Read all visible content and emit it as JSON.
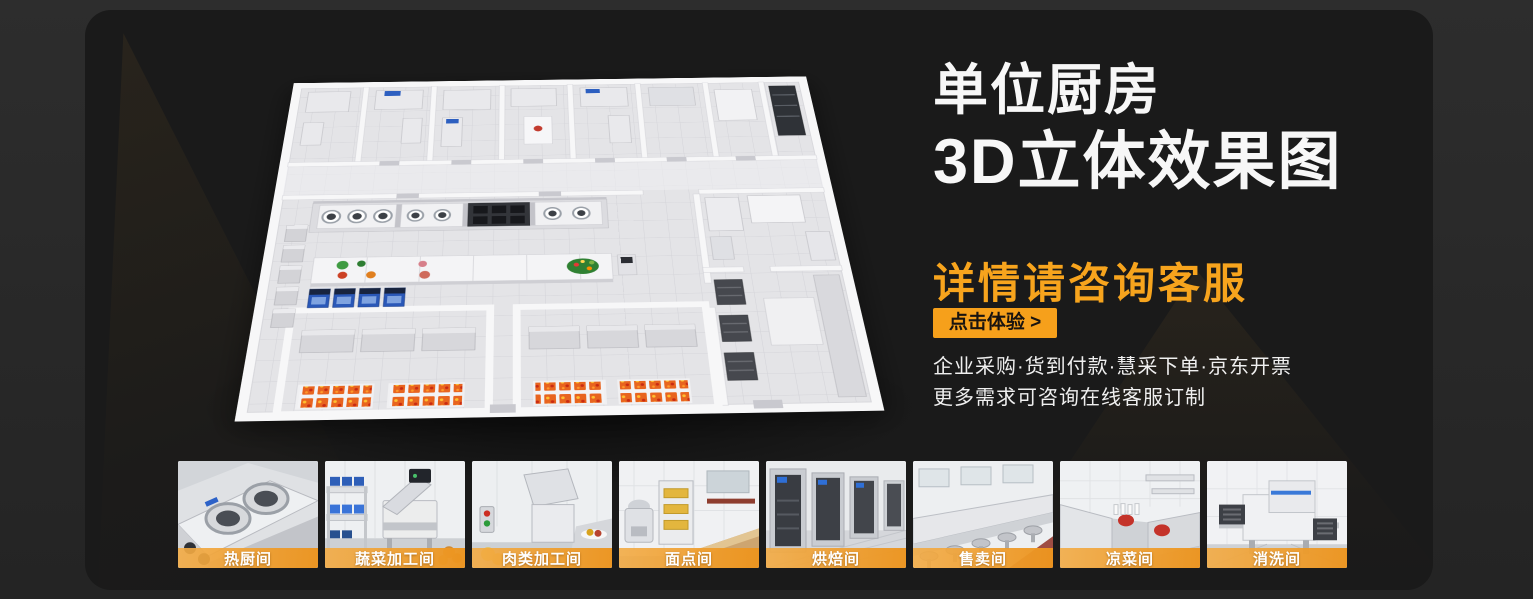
{
  "theme": {
    "accent_orange": "#F7A41D",
    "button_orange": "#F6A01B",
    "panel_bg": "#1a1a1a",
    "outer_bg": "#2b2b2b",
    "headline_color": "#f7f7f7"
  },
  "hero": {
    "title_line1": "单位厨房",
    "title_line2": "3D立体效果图",
    "subtitle": "详情请咨询客服",
    "cta_label": "点击体验 >",
    "desc_line1": "企业采购·货到付款·慧采下单·京东开票",
    "desc_line2": "更多需求可咨询在线客服订制",
    "image_alt": "单位厨房3D立体效果图"
  },
  "thumbnails": [
    {
      "id": "hot-kitchen",
      "label": "热厨间"
    },
    {
      "id": "vegetable-processing",
      "label": "蔬菜加工间"
    },
    {
      "id": "meat-processing",
      "label": "肉类加工间"
    },
    {
      "id": "pastry-room",
      "label": "面点间"
    },
    {
      "id": "baking-room",
      "label": "烘焙间"
    },
    {
      "id": "selling-room",
      "label": "售卖间"
    },
    {
      "id": "cold-dish-room",
      "label": "凉菜间"
    },
    {
      "id": "washing-room",
      "label": "消洗间"
    }
  ]
}
